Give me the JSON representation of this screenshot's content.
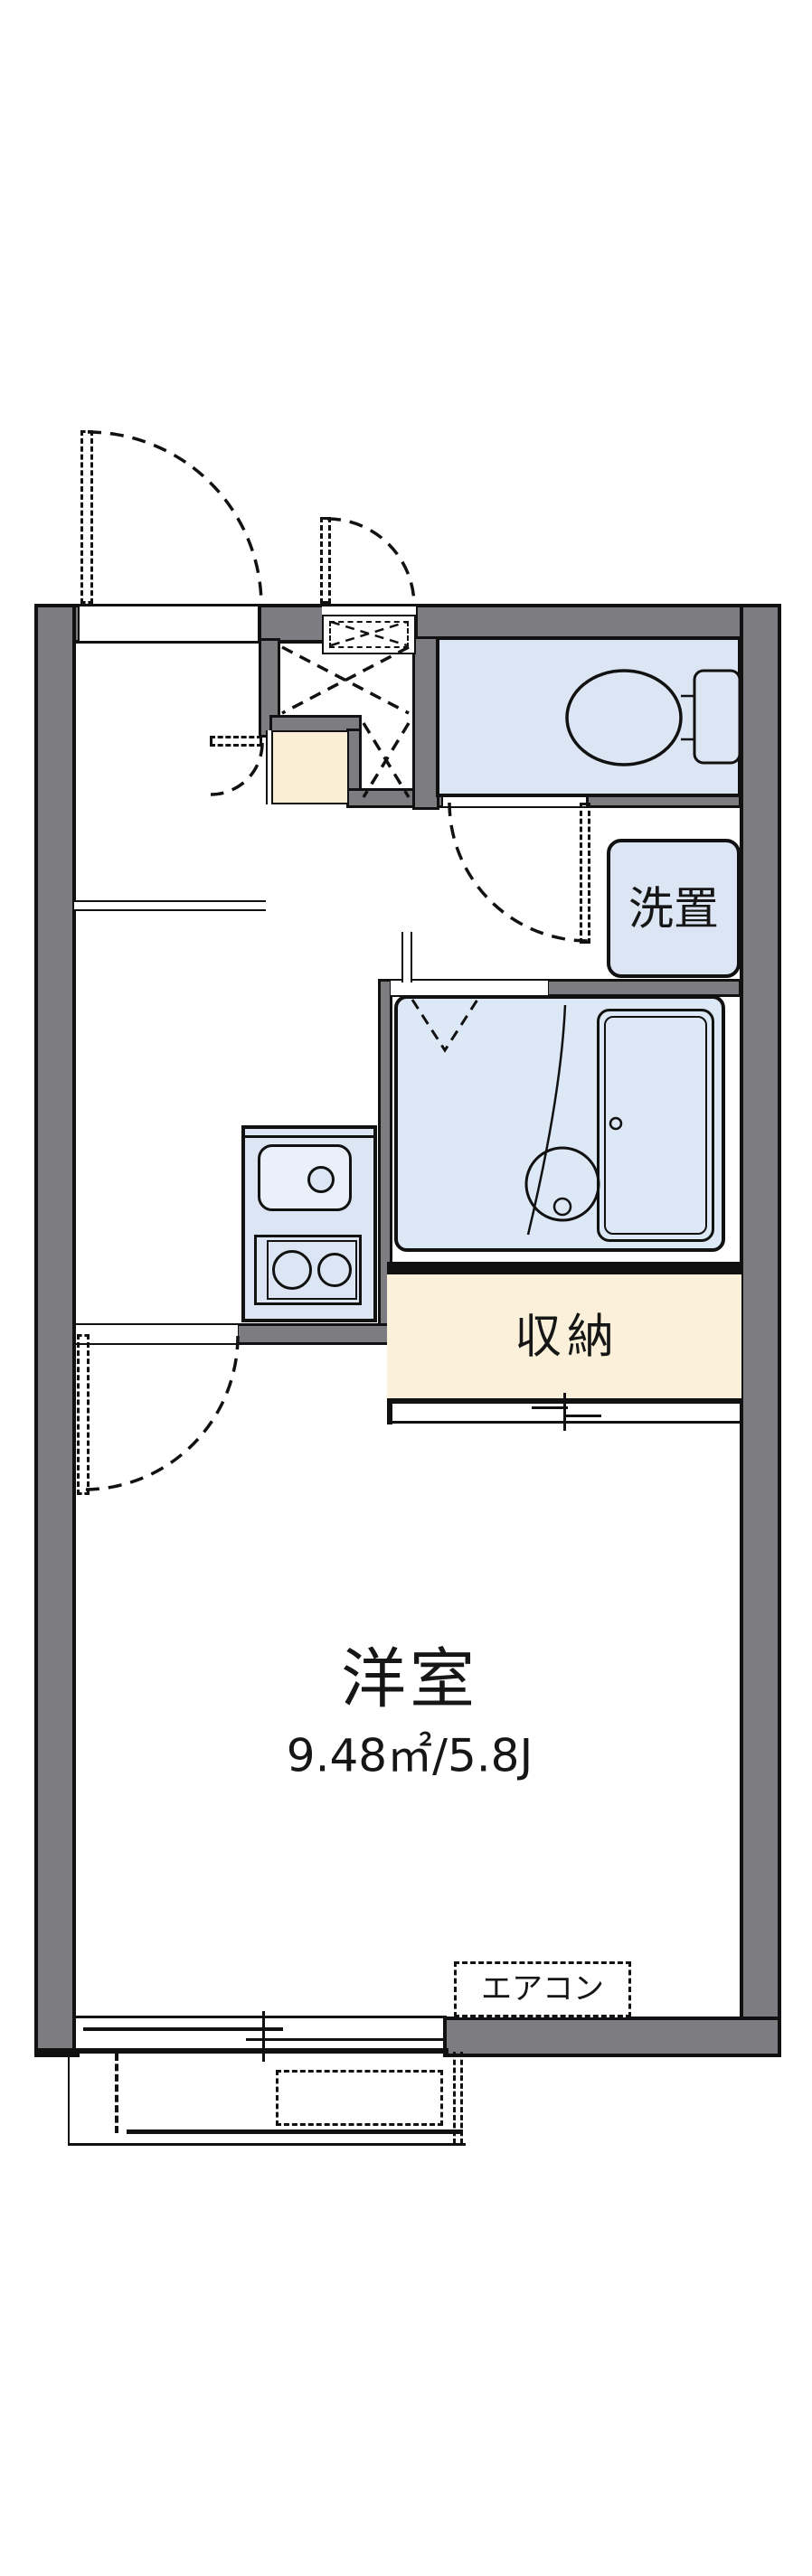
{
  "plan": {
    "labels": {
      "washer_space": "洗置",
      "storage": "収納",
      "main_room": "洋室",
      "main_room_area": "9.48㎡/5.8J",
      "air_conditioner": "エアコン"
    },
    "colors": {
      "wall_gray": "#7d7d81",
      "water_blue": "#dce5f4",
      "bath_blue": "#dde8f6",
      "sink_blue": "#e9f0fa",
      "storage_cream": "#fbf1da",
      "step_cream": "#faeed6",
      "line_black": "#111111",
      "background": "#ffffff"
    }
  }
}
